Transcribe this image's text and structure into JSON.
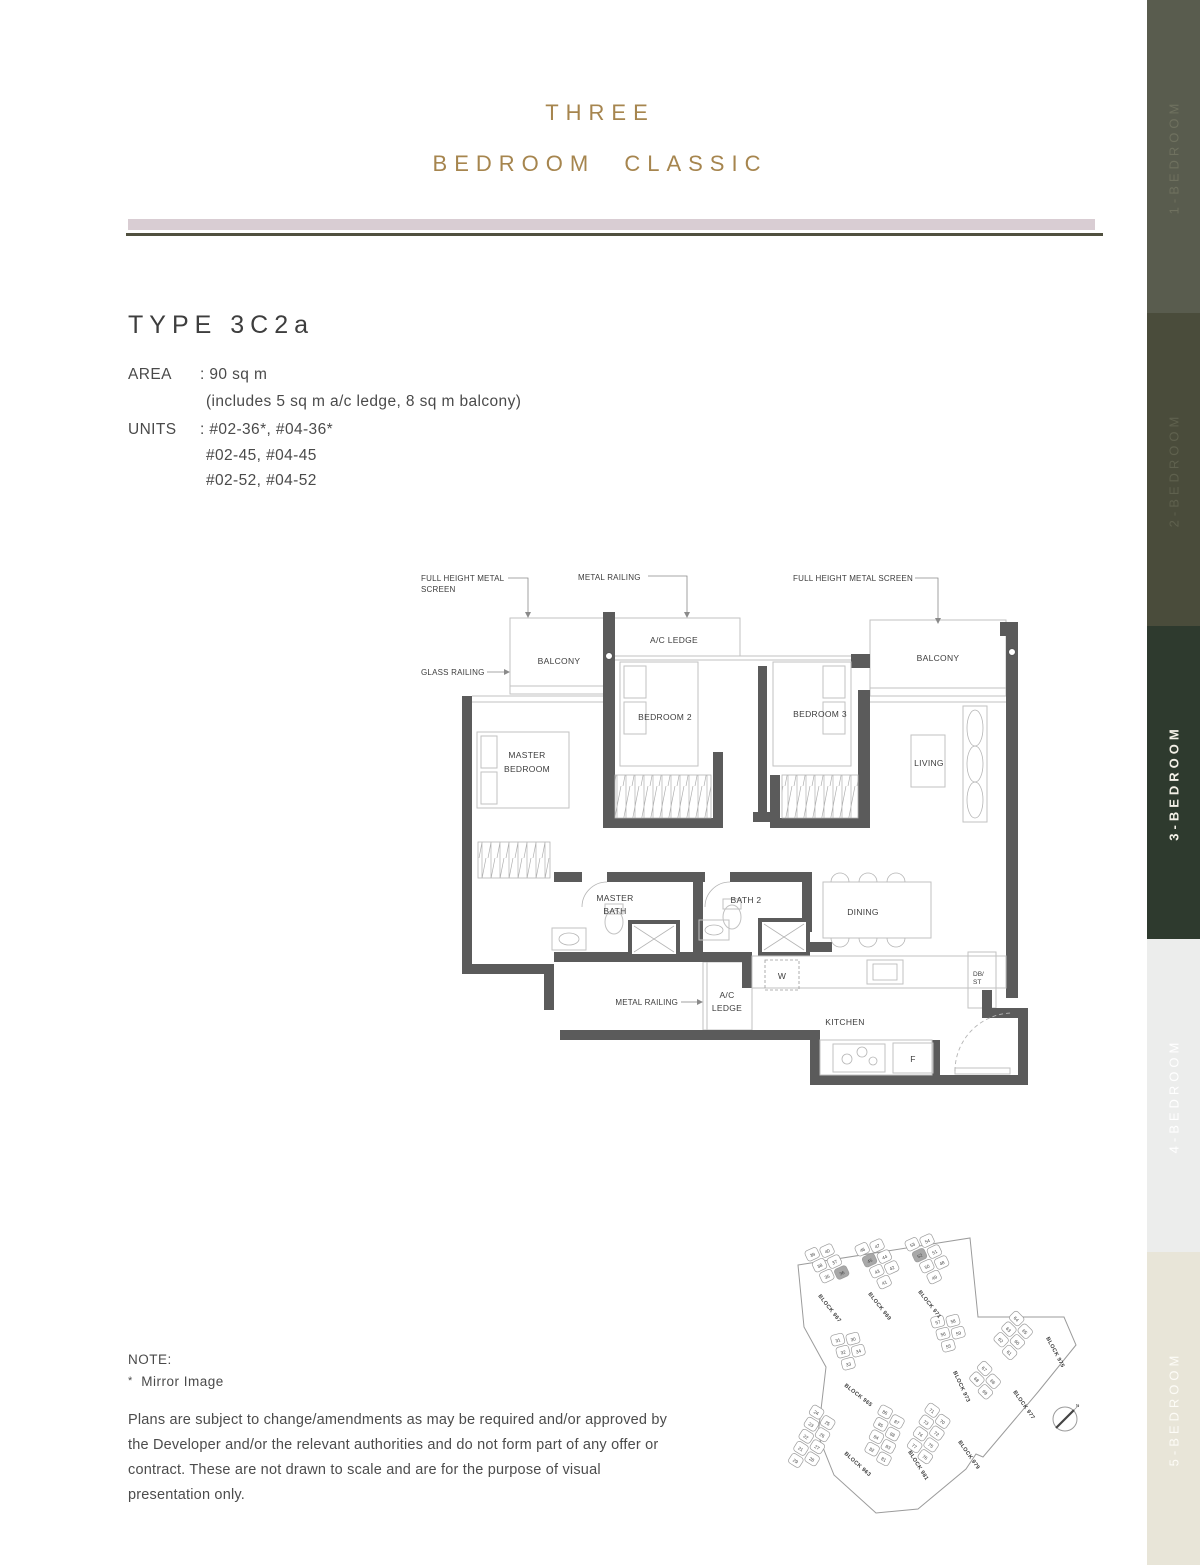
{
  "header": {
    "title_line1": "THREE",
    "title_line2": "BEDROOM CLASSIC"
  },
  "unit_info": {
    "type": "TYPE 3C2a",
    "area_label": "AREA",
    "area_value": ": 90 sq m",
    "area_note": "(includes 5 sq m a/c ledge, 8 sq m balcony)",
    "units_label": "UNITS",
    "units_line1": ": #02-36*, #04-36*",
    "units_line2": "#02-45, #04-45",
    "units_line3": "#02-52, #04-52"
  },
  "floorplan": {
    "annotations": {
      "screen_left_l1": "FULL HEIGHT METAL",
      "screen_left_l2": "SCREEN",
      "railing_top": "METAL RAILING",
      "screen_right": "FULL HEIGHT METAL SCREEN",
      "glass_railing": "GLASS RAILING",
      "railing_bottom": "METAL RAILING"
    },
    "rooms": {
      "balcony_left": "BALCONY",
      "ac_ledge_top": "A/C LEDGE",
      "balcony_right": "BALCONY",
      "bedroom2": "BEDROOM 2",
      "bedroom3": "BEDROOM 3",
      "living": "LIVING",
      "master_l1": "MASTER",
      "master_l2": "BEDROOM",
      "masterbath_l1": "MASTER",
      "masterbath_l2": "BATH",
      "bath2": "BATH 2",
      "dining": "DINING",
      "washer": "W",
      "acledge_b_l1": "A/C",
      "acledge_b_l2": "LEDGE",
      "kitchen": "KITCHEN",
      "fridge": "F",
      "db_l1": "DB/",
      "db_l2": "ST"
    }
  },
  "sidebar": {
    "items": [
      {
        "label": "1-BEDROOM",
        "bg": "#595c4e",
        "fg": "#6f715f",
        "active": false
      },
      {
        "label": "2-BEDROOM",
        "bg": "#4a4c3b",
        "fg": "#5f614e",
        "active": false
      },
      {
        "label": "3-BEDROOM",
        "bg": "#2e3a2e",
        "fg": "#f3f0e7",
        "active": true
      },
      {
        "label": "4-BEDROOM",
        "bg": "#ecedec",
        "fg": "#ffffff",
        "active": false
      },
      {
        "label": "5-BEDROOM",
        "bg": "#e8e5d8",
        "fg": "#fdfcf7",
        "active": false
      }
    ]
  },
  "sitemap": {
    "compass_n": "N",
    "highlight_color": "#a8a8a8",
    "blocks": [
      {
        "name": "BLOCK 967",
        "units": [
          "39",
          "40",
          "38",
          "37",
          "35",
          "36"
        ],
        "highlight": [
          "36"
        ]
      },
      {
        "name": "BLOCK 969",
        "units": [
          "46",
          "47",
          "45",
          "44",
          "43",
          "42",
          "41"
        ],
        "highlight": [
          "45"
        ]
      },
      {
        "name": "BLOCK 971",
        "units": [
          "53",
          "54",
          "52",
          "51",
          "50",
          "48",
          "49"
        ],
        "highlight": [
          "52"
        ]
      },
      {
        "name": "BLOCK 965",
        "units": [
          "31",
          "30",
          "32",
          "34",
          "33"
        ],
        "highlight": []
      },
      {
        "name": "BLOCK 973",
        "units": [
          "57",
          "58",
          "56",
          "59",
          "55"
        ],
        "highlight": []
      },
      {
        "name": "BLOCK 975",
        "units": [
          "64",
          "65",
          "63",
          "60",
          "62",
          "61"
        ],
        "highlight": []
      },
      {
        "name": "BLOCK 977",
        "units": [
          "67",
          "66",
          "68",
          "69"
        ],
        "highlight": []
      },
      {
        "name": "BLOCK 979",
        "units": [
          "71",
          "70",
          "73",
          "72",
          "74",
          "75",
          "77",
          "76"
        ],
        "highlight": []
      },
      {
        "name": "BLOCK 981",
        "units": [
          "86",
          "87",
          "85",
          "88",
          "84",
          "83",
          "82",
          "81"
        ],
        "highlight": []
      },
      {
        "name": "BLOCK 963",
        "units": [
          "24",
          "25",
          "23",
          "26",
          "22",
          "27",
          "21",
          "28",
          "29"
        ],
        "highlight": []
      }
    ]
  },
  "note": {
    "heading": "NOTE:",
    "mirror_star": "*",
    "mirror_text": "Mirror Image",
    "disclaimer": "Plans are subject to change/amendments as may be required and/or approved by the Developer and/or the relevant authorities and do not form part of any offer or contract. These are not drawn to scale and are for the purpose of visual presentation only."
  }
}
